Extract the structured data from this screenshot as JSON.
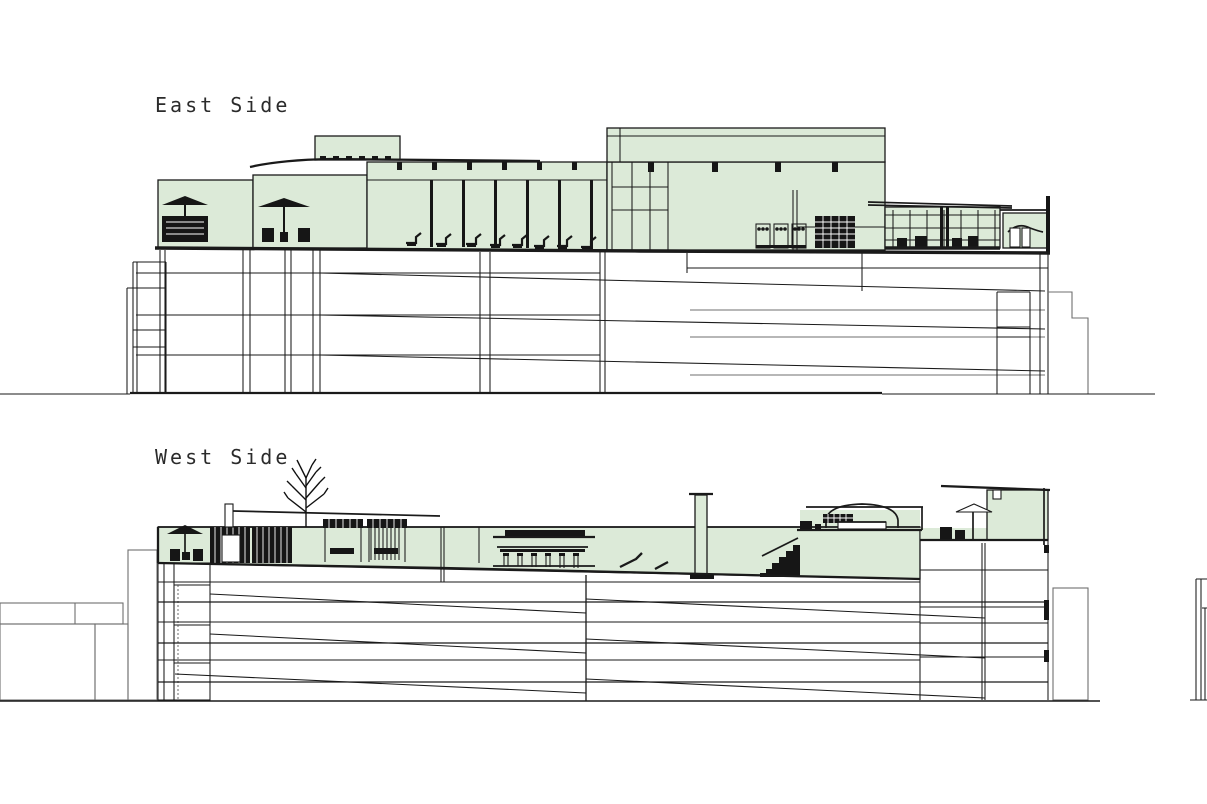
{
  "drawing": {
    "type": "architectural-section-elevations",
    "sections": [
      {
        "id": "east",
        "label": "East Side"
      },
      {
        "id": "west",
        "label": "West Side"
      }
    ],
    "colors": {
      "amenity_fill": "#dcead8",
      "line": "#1a1a1a",
      "secondary_line": "#6f6f6f",
      "background": "#ffffff"
    }
  }
}
